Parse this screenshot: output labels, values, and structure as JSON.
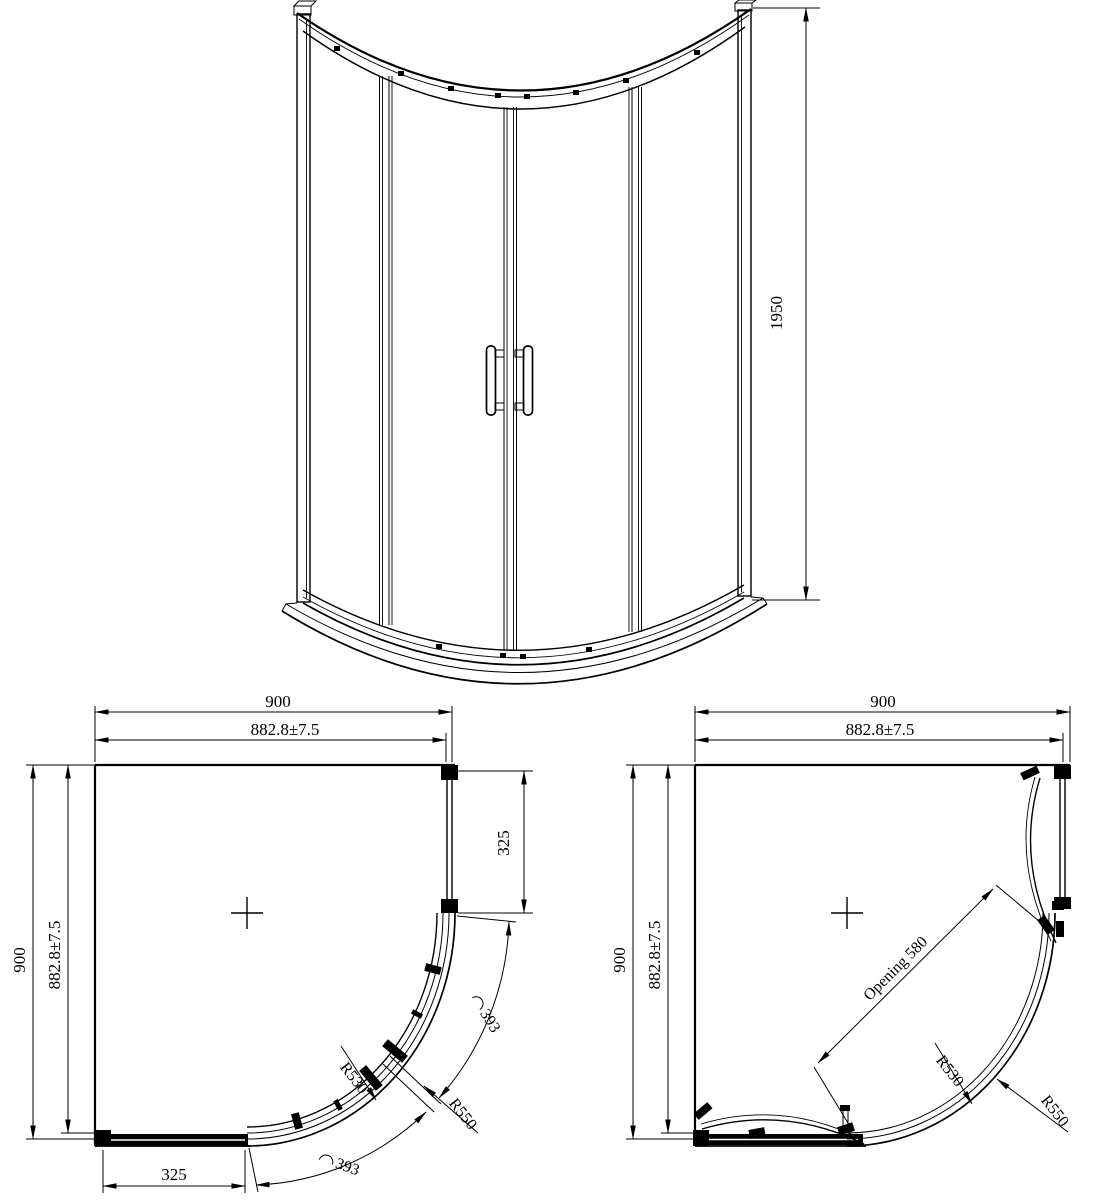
{
  "drawing": {
    "elevation": {
      "height": "1950"
    },
    "plan_closed": {
      "width": "900",
      "width_tol": "882.8±7.5",
      "height": "900",
      "height_tol": "882.8±7.5",
      "panel_side": "325",
      "panel_bottom": "325",
      "arc_top": "393",
      "arc_bottom": "393",
      "radius_inner": "R530",
      "radius_outer": "R550"
    },
    "plan_open": {
      "width": "900",
      "width_tol": "882.8±7.5",
      "height": "900",
      "height_tol": "882.8±7.5",
      "opening": "Opening 580",
      "radius_inner": "R530",
      "radius_outer": "R550"
    }
  }
}
